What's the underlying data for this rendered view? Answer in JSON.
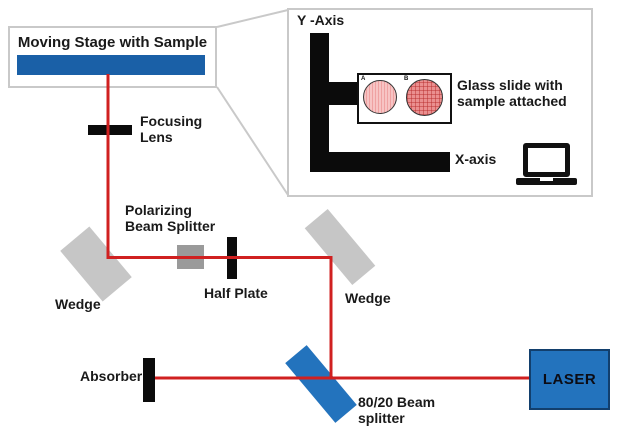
{
  "colors": {
    "beam_red": "#d02020",
    "stage_blue": "#1a60a7",
    "laser_blue": "#2373bd",
    "wedge_gray": "#c6c6c6",
    "pbs_gray": "#9a9a9a",
    "border_gray": "#c9c9c9"
  },
  "stage": {
    "title": "Moving Stage with Sample"
  },
  "inset": {
    "y_axis_label": "Y -Axis",
    "x_axis_label": "X-axis",
    "glass_slide_label": "Glass slide with\nsample attached",
    "sample_a": "A",
    "sample_b": "B"
  },
  "labels": {
    "focusing_lens": "Focusing\nLens",
    "polarizing_beam_splitter": "Polarizing\nBeam Splitter",
    "half_plate": "Half Plate",
    "wedge": "Wedge",
    "absorber": "Absorber",
    "beam_splitter_8020": "80/20 Beam\nsplitter",
    "laser": "LASER"
  }
}
